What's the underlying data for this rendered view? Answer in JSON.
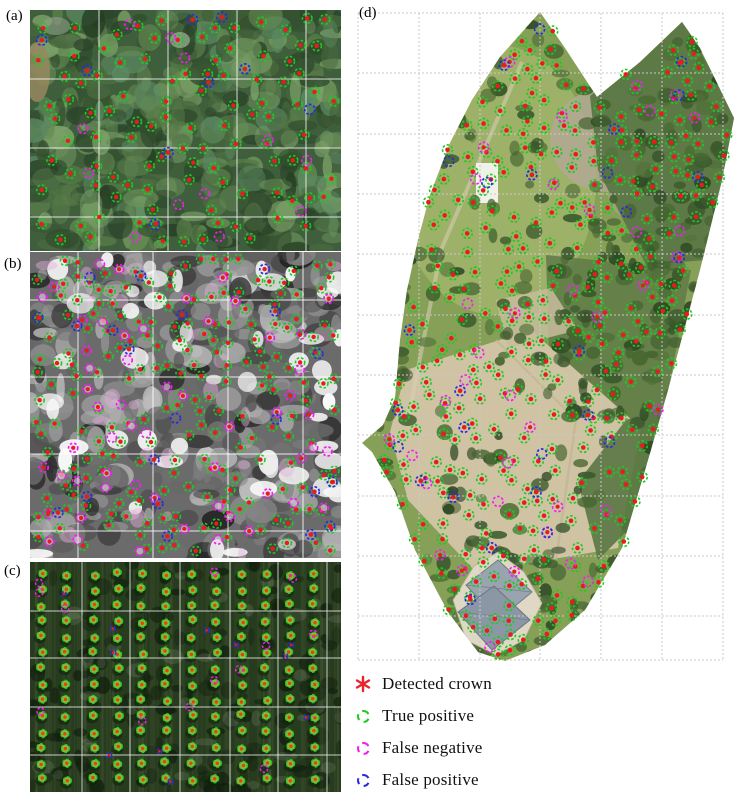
{
  "figure": {
    "title": "Tree crown detection results",
    "legend": {
      "items": [
        {
          "id": "detected-crown",
          "symbol": "asterisk",
          "color": "#e8232a",
          "label": "Detected  crown"
        },
        {
          "id": "true-positive",
          "symbol": "dashed-circle",
          "color": "#1ecb1e",
          "label": "True positive"
        },
        {
          "id": "false-negative",
          "symbol": "dashed-circle",
          "color": "#f21df2",
          "label": "False negative"
        },
        {
          "id": "false-positive",
          "symbol": "dashed-circle",
          "color": "#2b2bdc",
          "label": "False positive"
        }
      ]
    },
    "marker_colors": {
      "detected_crown": "#e81c1c",
      "true_positive": "#1ecb1e",
      "false_negative": "#f21df2",
      "false_positive": "#2b2bdc"
    },
    "panels": {
      "a": {
        "label": "(a)",
        "scene": "dense forest canopy orthophoto tiles with white grid",
        "marker_counts": {
          "true_positive": 104,
          "false_negative": 12,
          "false_positive": 9
        }
      },
      "b": {
        "label": "(b)",
        "scene": "grayscale orchard tiles with bright flowering crowns, dense detections",
        "marker_counts": {
          "true_positive": 208,
          "false_negative": 56,
          "false_positive": 21
        }
      },
      "c": {
        "label": "(c)",
        "scene": "young plantation rows on dark green field",
        "marker_counts": {
          "true_positive": 168,
          "false_negative": 13,
          "false_positive": 11
        }
      },
      "d": {
        "label": "(d)",
        "scene": "full site orthomosaic over light grid, irregular polygon with grass, orchards, sandy ground and a building",
        "marker_counts": {
          "true_positive": 332,
          "false_negative": 38,
          "false_positive": 27
        }
      }
    }
  }
}
